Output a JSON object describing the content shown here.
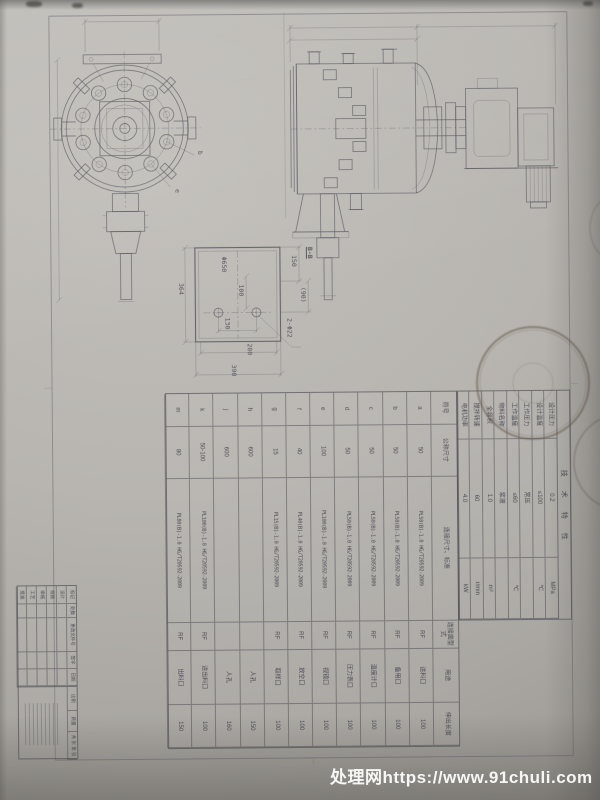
{
  "watermark": {
    "text": "处理网https://www.91chuli.com"
  },
  "stamp": {
    "text": "MACHINERY"
  },
  "dim_labels": [
    {
      "text": "Φ650",
      "x": 222,
      "y": 256
    },
    {
      "text": "100",
      "x": 239,
      "y": 284
    },
    {
      "text": "130",
      "x": 225,
      "y": 317
    },
    {
      "text": "280",
      "x": 247,
      "y": 343
    },
    {
      "text": "390",
      "x": 231,
      "y": 364
    },
    {
      "text": "364",
      "x": 179,
      "y": 282
    },
    {
      "text": "150",
      "x": 292,
      "y": 255
    },
    {
      "text": "(90)",
      "x": 301,
      "y": 287
    },
    {
      "text": "B-B",
      "x": 308,
      "y": 247,
      "u": 1
    },
    {
      "text": "2-Φ22",
      "x": 287,
      "y": 318
    },
    {
      "text": "b",
      "x": 199,
      "y": 150
    },
    {
      "text": "e",
      "x": 176,
      "y": 188
    }
  ],
  "nozzle_table": {
    "headers": [
      "符号",
      "公称尺寸",
      "连接尺寸、标准",
      "连接面型式",
      "用途",
      "伸出长度"
    ],
    "rows": [
      {
        "code": "a",
        "dn": "50",
        "std": "PL50(B)-1.0 HG/T20592-2009",
        "face": "RF",
        "use": "进料口",
        "len": "100"
      },
      {
        "code": "b",
        "dn": "50",
        "std": "PL50(B)-1.0 HG/T20592-2009",
        "face": "RF",
        "use": "备用口",
        "len": "100"
      },
      {
        "code": "c",
        "dn": "50",
        "std": "PL50(B)-1.0 HG/T20592-2009",
        "face": "RF",
        "use": "温度计口",
        "len": "100"
      },
      {
        "code": "d",
        "dn": "50",
        "std": "PL50(B)-1.0 HG/T20592-2009",
        "face": "RF",
        "use": "压力表口",
        "len": "100"
      },
      {
        "code": "e",
        "dn": "100",
        "std": "PL100(B)-1.0 HG/T20592-2009",
        "face": "RF",
        "use": "视镜口",
        "len": "100"
      },
      {
        "code": "f",
        "dn": "40",
        "std": "PL40(B)-1.0 HG/T20592-2009",
        "face": "RF",
        "use": "放空口",
        "len": "100"
      },
      {
        "code": "g",
        "dn": "15",
        "std": "PL15(B)-1.0 HG/T20592-2009",
        "face": "RF",
        "use": "取样口",
        "len": "100"
      },
      {
        "code": "h",
        "dn": "600",
        "std": "",
        "face": "",
        "use": "人孔",
        "len": "150"
      },
      {
        "code": "j",
        "dn": "600",
        "std": "",
        "face": "",
        "use": "人孔",
        "len": "160"
      },
      {
        "code": "k",
        "dn": "50-100",
        "std": "PL100(B)-1.0 HG/T20592-2009",
        "face": "RF",
        "use": "进出料口",
        "len": "100"
      },
      {
        "code": "m",
        "dn": "80",
        "std": "PL80(B)-1.0 HG/T20592-2009",
        "face": "RF",
        "use": "出料口",
        "len": "150"
      }
    ]
  },
  "tech_table": {
    "title": "技术特性",
    "rows": [
      {
        "name": "设计压力",
        "value": "0.2",
        "unit": "MPa"
      },
      {
        "name": "设计温度",
        "value": "≤100",
        "unit": "℃"
      },
      {
        "name": "工作压力",
        "value": "常压",
        "unit": ""
      },
      {
        "name": "工作温度",
        "value": "≤60",
        "unit": "℃"
      },
      {
        "name": "物料名称",
        "value": "浆液",
        "unit": ""
      },
      {
        "name": "全容积",
        "value": "1.0",
        "unit": "m³"
      },
      {
        "name": "搅拌转速",
        "value": "60",
        "unit": "r/min"
      },
      {
        "name": "电机功率",
        "value": "4.0",
        "unit": "kW"
      }
    ]
  },
  "title_block": {
    "rev_headers": [
      "标记",
      "处数",
      "更改文件号",
      "签字",
      "日期"
    ],
    "sign_labels": [
      "设计",
      "校核",
      "审核",
      "工艺",
      "批准"
    ],
    "scale_label": "比例",
    "mass_label": "质量",
    "sheet_label": "共 张 第 张"
  }
}
